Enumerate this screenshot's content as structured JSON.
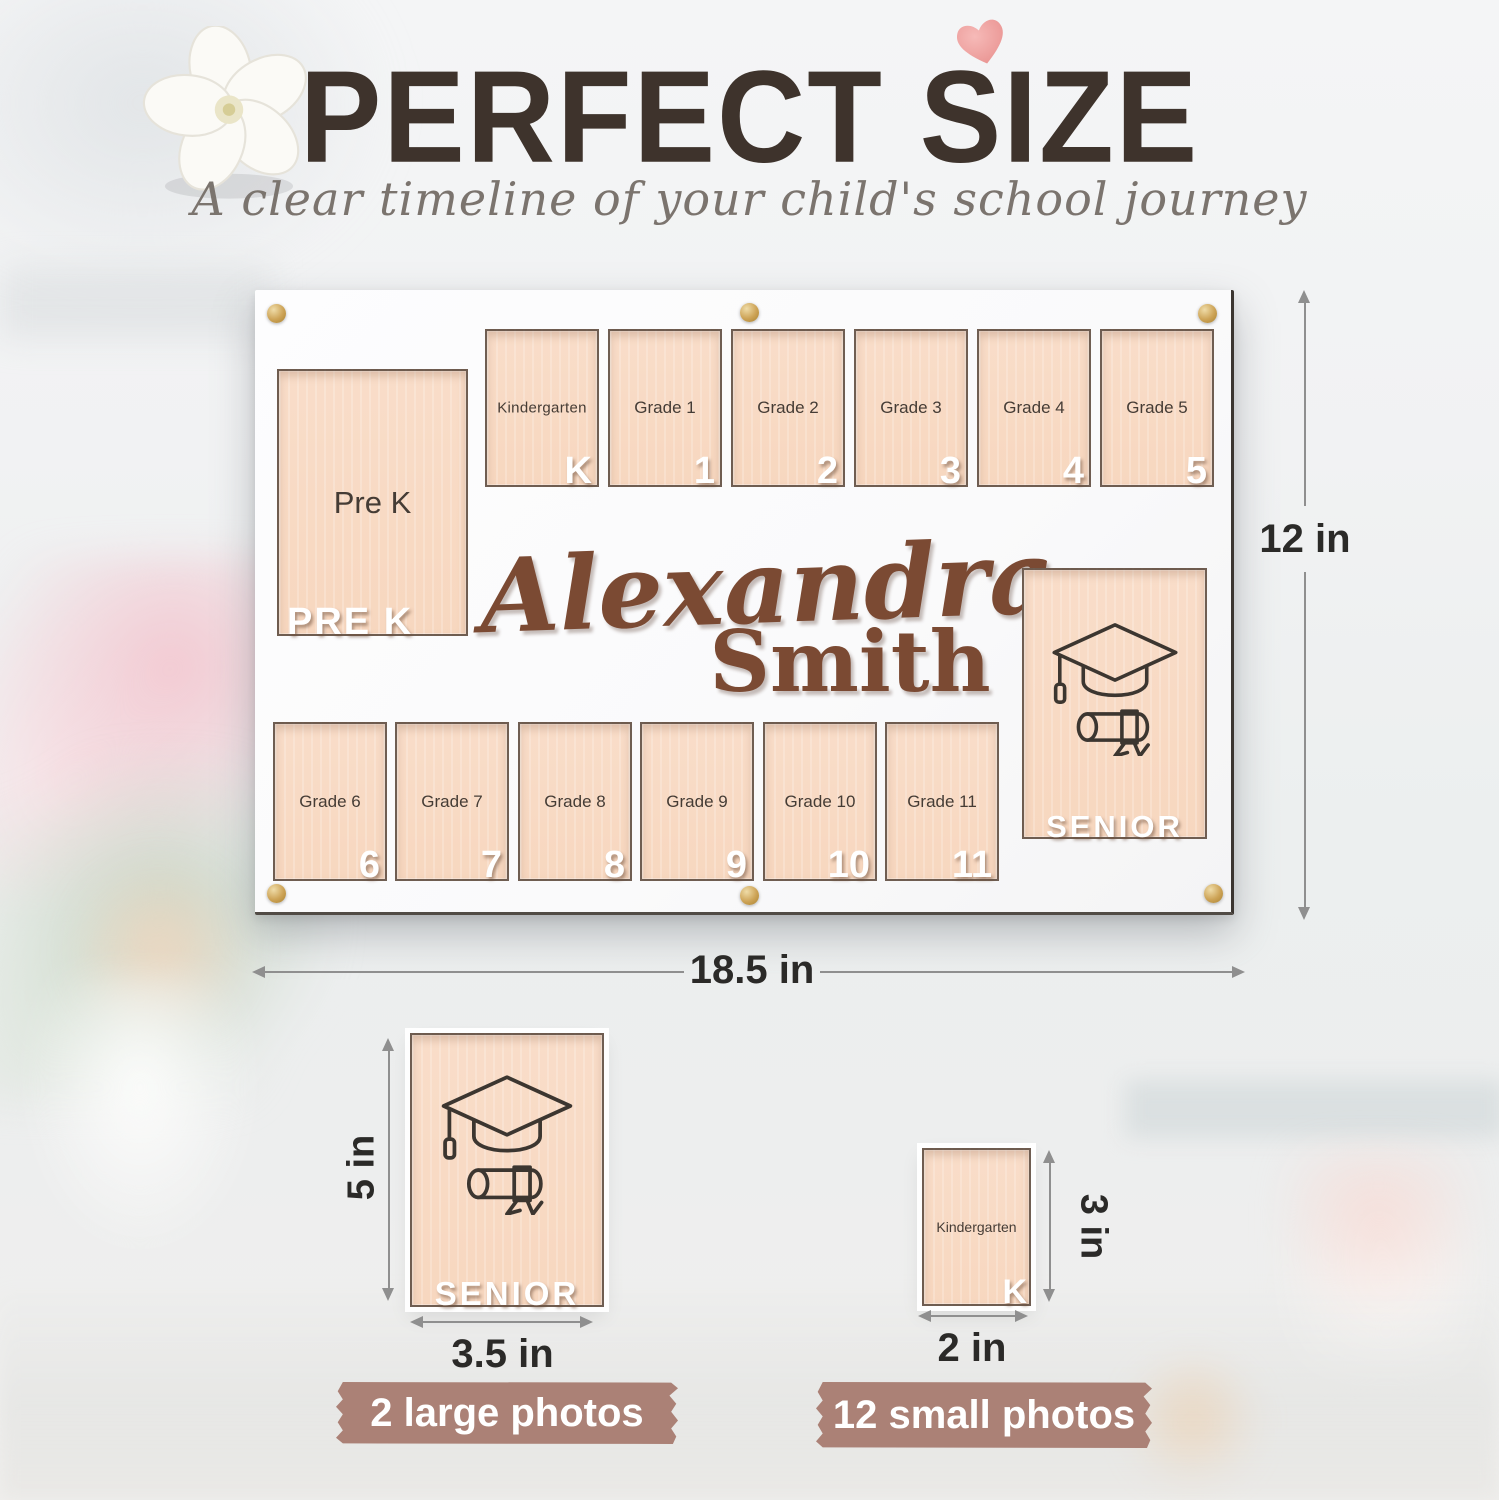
{
  "header": {
    "title": "PERFECT SIZE",
    "subtitle": "A clear timeline of your child's school journey"
  },
  "frame": {
    "name_first": "Alexandra",
    "name_last": "Smith",
    "pre_k": {
      "label": "Pre K",
      "cutout": "PRE K"
    },
    "top_slots": [
      {
        "label": "Kindergarten",
        "cutout": "K"
      },
      {
        "label": "Grade 1",
        "cutout": "1"
      },
      {
        "label": "Grade 2",
        "cutout": "2"
      },
      {
        "label": "Grade 3",
        "cutout": "3"
      },
      {
        "label": "Grade 4",
        "cutout": "4"
      },
      {
        "label": "Grade 5",
        "cutout": "5"
      }
    ],
    "bottom_slots": [
      {
        "label": "Grade 6",
        "cutout": "6"
      },
      {
        "label": "Grade 7",
        "cutout": "7"
      },
      {
        "label": "Grade 8",
        "cutout": "8"
      },
      {
        "label": "Grade 9",
        "cutout": "9"
      },
      {
        "label": "Grade 10",
        "cutout": "10"
      },
      {
        "label": "Grade 11",
        "cutout": "11"
      }
    ],
    "senior": {
      "cutout": "SENIOR"
    }
  },
  "dimensions": {
    "frame_height": "12 in",
    "frame_width": "18.5 in"
  },
  "large_photo": {
    "height": "5 in",
    "width": "3.5 in",
    "cutout": "SENIOR",
    "tape": "2 large photos"
  },
  "small_photo": {
    "height": "3 in",
    "width": "2 in",
    "label": "Kindergarten",
    "cutout": "K",
    "tape": "12 small photos"
  },
  "colors": {
    "title_brown": "#3e332c",
    "name_wood_brown": "#7b4a33",
    "slot_peach": "#f8dcc6",
    "tape_mauve": "#ab8176",
    "pin_gold": "#cda356",
    "heart_pink": "#efa3a1"
  }
}
